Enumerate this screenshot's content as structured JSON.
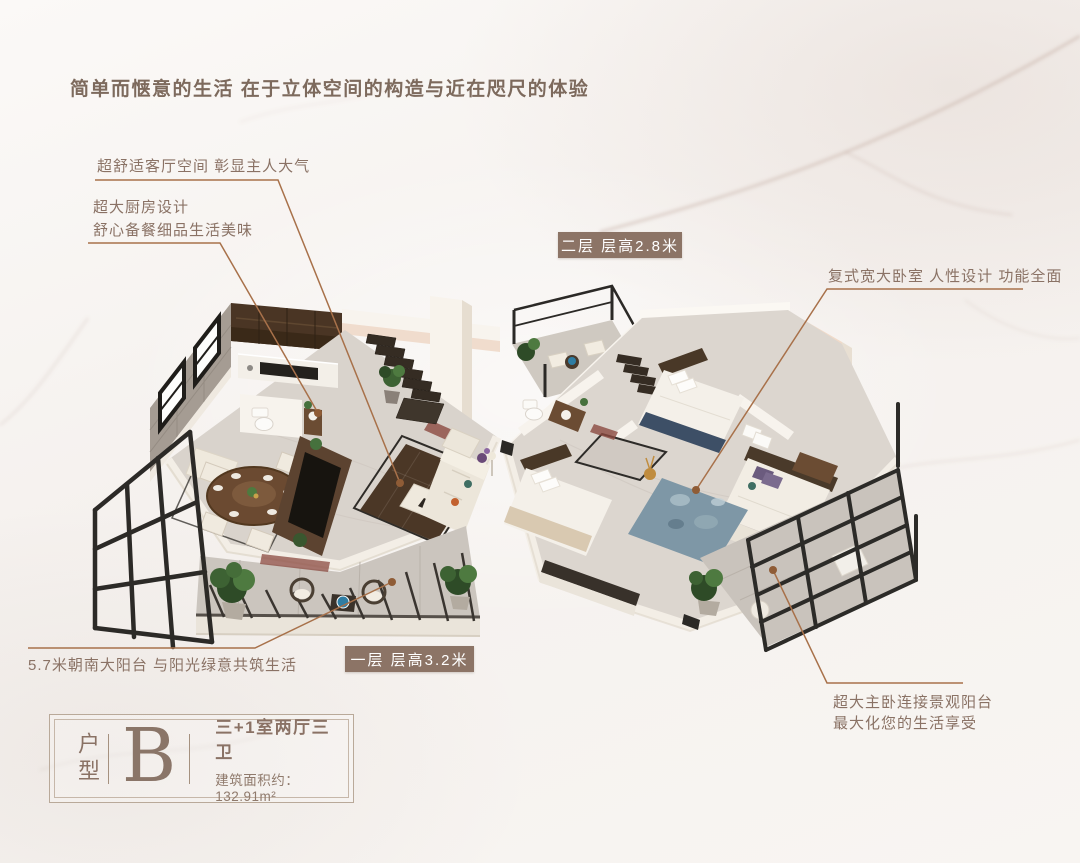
{
  "headline": "简单而惬意的生活  在于立体空间的构造与近在咫尺的体验",
  "callouts": {
    "living_room": "超舒适客厅空间  彰显主人大气",
    "kitchen_line1": "超大厨房设计",
    "kitchen_line2": "舒心备餐细品生活美味",
    "bedroom": "复式宽大卧室  人性设计  功能全面",
    "south_balcony": "5.7米朝南大阳台  与阳光绿意共筑生活",
    "master_balcony_line1": "超大主卧连接景观阳台",
    "master_balcony_line2": "最大化您的生活享受"
  },
  "floor_badges": {
    "second": "二层 层高2.8米",
    "first": "一层 层高3.2米"
  },
  "unit_card": {
    "category": "户型",
    "letter": "B",
    "layout": "三+1室两厅三卫",
    "area": "建筑面积约：132.91m²"
  },
  "colors": {
    "accent_text": "#8a7265",
    "headline_text": "#7d6a5d",
    "badge_background": "#8c7466",
    "leader_line": "#a8714a",
    "leader_dot": "#8f5c36",
    "card_border": "#b9a999",
    "wall_peach": "#f0dccd",
    "floor_marble": "#d9d3cc"
  }
}
